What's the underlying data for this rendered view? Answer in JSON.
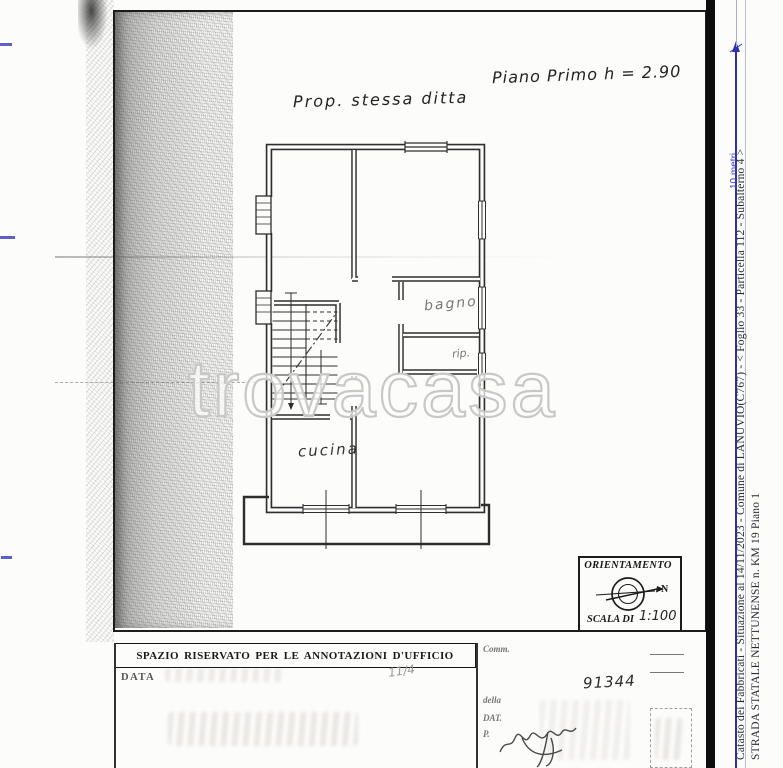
{
  "document": {
    "handwritten_title": "Piano Primo h = 2.90",
    "property_note": "Prop. stessa ditta"
  },
  "plan": {
    "room_labels": {
      "bagno": "bagno",
      "rip": "rip.",
      "cucina": "cucina"
    }
  },
  "orientation_box": {
    "title": "ORIENTAMENTO",
    "north": "N",
    "scale_label": "SCALA DI",
    "scale_value": "1:100"
  },
  "scale_bar": {
    "label": "10 metri"
  },
  "watermark": {
    "text": "trovacasa"
  },
  "office_section": {
    "header": "SPAZIO RISERVATO PER LE ANNOTAZIONI D'UFFICIO",
    "data_label": "DATA",
    "handwritten_fraction": "11/4",
    "right_column": {
      "committente_label": "Comm.",
      "della_label": "della",
      "dat_label": "DAT.",
      "p_label": "P.",
      "protocol_number": "91344"
    }
  },
  "right_margin": {
    "line1": "Catasto dei Fabbricati - Situazione al 14/11/2023 - Comune di LANUVIO(C767) - <  Foglio 33 - Particella 112 - Subalterno 4 >",
    "line2": "STRADA STATALE NETTUNENSE n. KM 19 Piano 1"
  },
  "colors": {
    "ink": "#2e2e2e",
    "scale_blue": "#2f2fb5",
    "margin_line": "#b9b9da"
  }
}
